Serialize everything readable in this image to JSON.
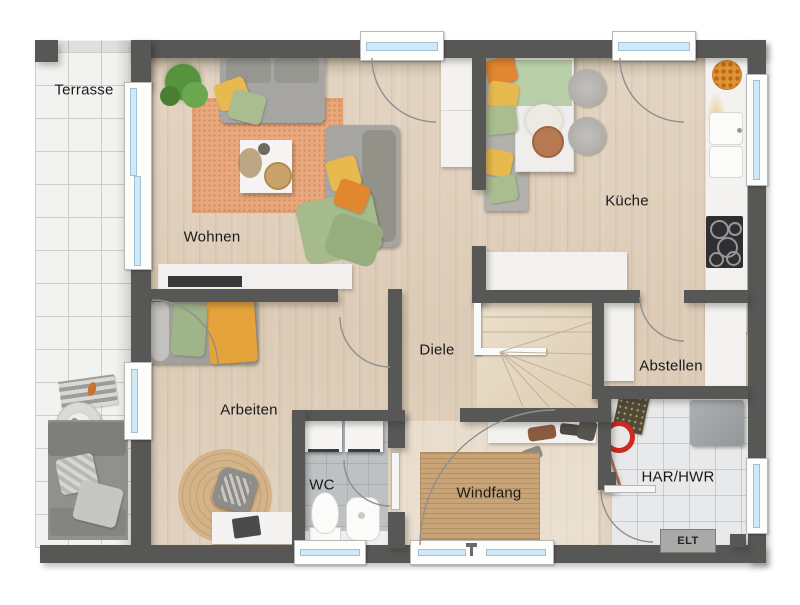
{
  "plan": {
    "rooms": {
      "terrasse": "Terrasse",
      "wohnen": "Wohnen",
      "kueche": "Küche",
      "diele": "Diele",
      "arbeiten": "Arbeiten",
      "wc": "WC",
      "windfang": "Windfang",
      "abstellen": "Abstellen",
      "har_hwr": "HAR/HWR",
      "elt": "ELT"
    },
    "colors": {
      "wall": "#575756",
      "wood_floor": "#ddcdb9",
      "terrace_tile": "#f2f2f0",
      "wc_tile": "#bdc1c3",
      "utility_tile": "#e8e9ea",
      "window_glass": "#cfe9f6",
      "living_rug": "#e9a97e",
      "sisal_rug": "#c9a478",
      "accent_orange": "#e2862f",
      "accent_yellow": "#e7b94f",
      "accent_green": "#a9bd8f"
    }
  }
}
